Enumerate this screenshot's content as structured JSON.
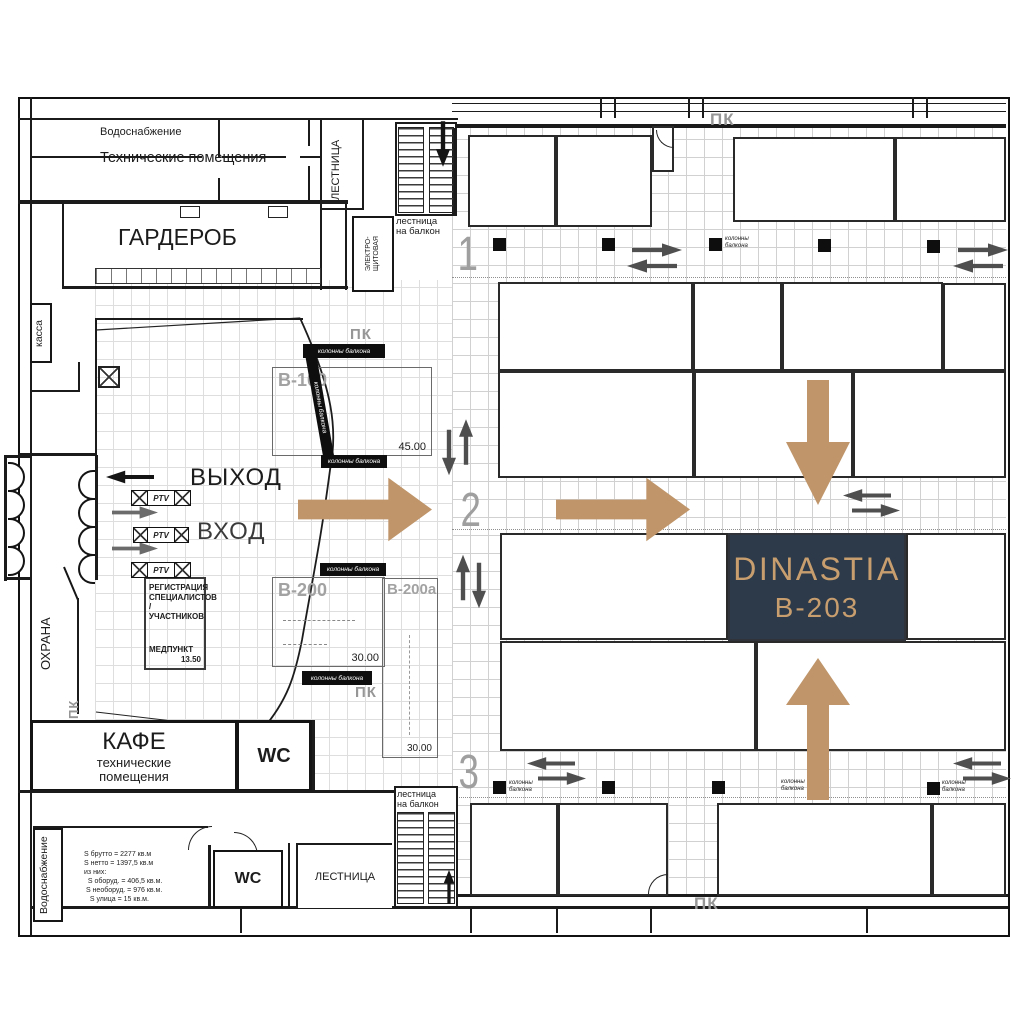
{
  "palette": {
    "accent_tan": "#bf9569",
    "navy": "#2c3a49",
    "tan_text": "#c89e6f",
    "gray_label": "#a2a2a2",
    "arrow_gray": "#4f4f4f"
  },
  "top": {
    "water": "Водоснабжение",
    "tech": "Технические помещения",
    "stairs": "ЛЕСТНИЦА",
    "cloakroom": "ГАРДЕРОБ",
    "electro1": "ЭЛЕКТРО-",
    "electro2": "ЩИТОВАЯ",
    "balcony1": "лестница",
    "balcony2": "на балкон"
  },
  "left": {
    "cashier": "касса",
    "exit": "ВЫХОД",
    "enter": "ВХОД",
    "security": "ОХРАНА"
  },
  "registration": {
    "l1": "РЕГИСТРАЦИЯ",
    "l2": "СПЕЦИАЛИСТОВ /",
    "l3": "УЧАСТНИКОВ",
    "med": "МЕДПУНКТ",
    "med_value": "13.50"
  },
  "booths": {
    "b100": "B-100",
    "b100_area": "45.00",
    "b200": "B-200",
    "b200_area": "30.00",
    "b200a": "B-200a",
    "b200a_area": "30.00"
  },
  "highlight": {
    "brand": "DINASTIA",
    "booth_id": "B-203"
  },
  "markers": {
    "pk": "ПК",
    "columns": "колонны балкона",
    "columns_l1": "колонны",
    "columns_l2": "балкона",
    "turnstile": "PTV"
  },
  "rows": [
    "1",
    "2",
    "3"
  ],
  "bottom": {
    "cafe": "КАФЕ",
    "cafe_sub1": "технические",
    "cafe_sub2": "помещения",
    "wc": "WC",
    "stairs": "ЛЕСТНИЦА",
    "water": "Водоснабжение",
    "balcony1": "лестница",
    "balcony2": "на балкон"
  },
  "stats": {
    "l1": "S брутто = 2277 кв.м",
    "l2": "S нетто = 1397,5 кв.м",
    "l3": "из них:",
    "l4": "  S оборуд. = 406,5 кв.м.",
    "l5": " S необоруд. = 976 кв.м.",
    "l6": "   S улица = 15 кв.м."
  }
}
